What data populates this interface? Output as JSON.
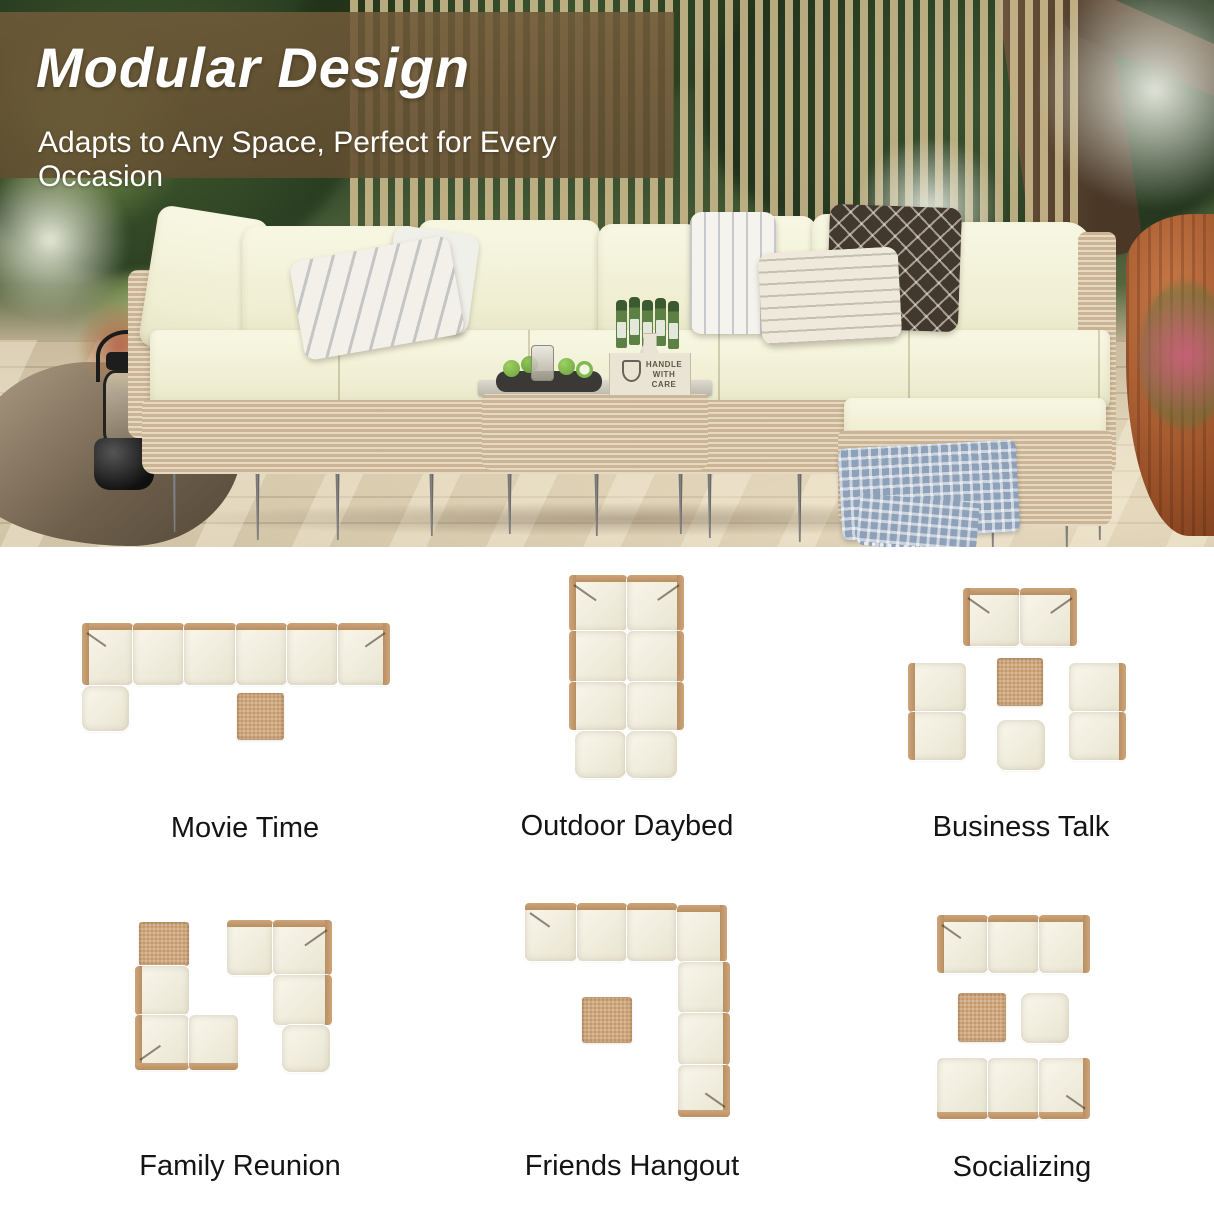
{
  "banner": {
    "title": "Modular Design",
    "subtitle": "Adapts to Any Space, Perfect for Every Occasion"
  },
  "photo": {
    "caddy_line1": "HANDLE",
    "caddy_line2": "WITH CARE"
  },
  "colors": {
    "cushion_cream": "#f2f0da",
    "wicker_frame": "#c49d72",
    "table_tan": "#d2a87c",
    "banner_brown": "#6d5737",
    "blanket_blue": "#8ea1b8",
    "label_text": "#141414"
  },
  "layouts": [
    {
      "id": "movie-time",
      "label": "Movie Time",
      "modules": [
        {
          "t": "seat",
          "x": 82,
          "y": 623,
          "w": 51,
          "h": 62,
          "back": "tl",
          "arm": "tl"
        },
        {
          "t": "seat",
          "x": 133,
          "y": 623,
          "w": 51,
          "h": 62,
          "back": "t"
        },
        {
          "t": "seat",
          "x": 184,
          "y": 623,
          "w": 52,
          "h": 62,
          "back": "t"
        },
        {
          "t": "seat",
          "x": 236,
          "y": 623,
          "w": 51,
          "h": 62,
          "back": "t"
        },
        {
          "t": "seat",
          "x": 287,
          "y": 623,
          "w": 51,
          "h": 62,
          "back": "t"
        },
        {
          "t": "seat",
          "x": 338,
          "y": 623,
          "w": 52,
          "h": 62,
          "back": "tr",
          "arm": "tr"
        },
        {
          "t": "ottoman",
          "x": 82,
          "y": 686,
          "w": 47,
          "h": 45
        },
        {
          "t": "table",
          "x": 237,
          "y": 693,
          "w": 47,
          "h": 47
        }
      ]
    },
    {
      "id": "outdoor-daybed",
      "label": "Outdoor Daybed",
      "modules": [
        {
          "t": "seat",
          "x": 569,
          "y": 575,
          "w": 58,
          "h": 56,
          "back": "tl",
          "arm": "tl"
        },
        {
          "t": "seat",
          "x": 627,
          "y": 575,
          "w": 57,
          "h": 56,
          "back": "tr",
          "arm": "tr"
        },
        {
          "t": "seat",
          "x": 569,
          "y": 631,
          "w": 58,
          "h": 51,
          "back": "l"
        },
        {
          "t": "seat",
          "x": 627,
          "y": 631,
          "w": 57,
          "h": 51,
          "back": "r"
        },
        {
          "t": "seat",
          "x": 569,
          "y": 682,
          "w": 58,
          "h": 48,
          "back": "l"
        },
        {
          "t": "seat",
          "x": 627,
          "y": 682,
          "w": 57,
          "h": 48,
          "back": "r"
        },
        {
          "t": "ottoman",
          "x": 575,
          "y": 731,
          "w": 51,
          "h": 47
        },
        {
          "t": "ottoman",
          "x": 626,
          "y": 731,
          "w": 51,
          "h": 47
        }
      ]
    },
    {
      "id": "business-talk",
      "label": "Business Talk",
      "modules": [
        {
          "t": "seat",
          "x": 963,
          "y": 588,
          "w": 57,
          "h": 58,
          "back": "tl",
          "arm": "tl"
        },
        {
          "t": "seat",
          "x": 1020,
          "y": 588,
          "w": 57,
          "h": 58,
          "back": "tr",
          "arm": "tr"
        },
        {
          "t": "seat",
          "x": 908,
          "y": 663,
          "w": 58,
          "h": 49,
          "back": "l"
        },
        {
          "t": "seat",
          "x": 908,
          "y": 712,
          "w": 58,
          "h": 48,
          "back": "l"
        },
        {
          "t": "seat",
          "x": 1069,
          "y": 663,
          "w": 57,
          "h": 49,
          "back": "r"
        },
        {
          "t": "seat",
          "x": 1069,
          "y": 712,
          "w": 57,
          "h": 48,
          "back": "r"
        },
        {
          "t": "table",
          "x": 997,
          "y": 658,
          "w": 46,
          "h": 48
        },
        {
          "t": "ottoman",
          "x": 997,
          "y": 720,
          "w": 48,
          "h": 50
        }
      ]
    },
    {
      "id": "family-reunion",
      "label": "Family Reunion",
      "modules": [
        {
          "t": "table",
          "x": 139,
          "y": 922,
          "w": 50,
          "h": 44
        },
        {
          "t": "seat",
          "x": 135,
          "y": 966,
          "w": 54,
          "h": 49,
          "back": "l"
        },
        {
          "t": "seat",
          "x": 135,
          "y": 1015,
          "w": 54,
          "h": 55,
          "back": "lb",
          "arm": "bl"
        },
        {
          "t": "seat",
          "x": 189,
          "y": 1015,
          "w": 49,
          "h": 55,
          "back": "b"
        },
        {
          "t": "seat",
          "x": 227,
          "y": 920,
          "w": 46,
          "h": 55,
          "back": "t"
        },
        {
          "t": "seat",
          "x": 273,
          "y": 920,
          "w": 59,
          "h": 55,
          "back": "tr",
          "arm": "tr"
        },
        {
          "t": "seat",
          "x": 273,
          "y": 975,
          "w": 59,
          "h": 50,
          "back": "r"
        },
        {
          "t": "ottoman",
          "x": 282,
          "y": 1025,
          "w": 48,
          "h": 47
        }
      ]
    },
    {
      "id": "friends-hangout",
      "label": "Friends Hangout",
      "modules": [
        {
          "t": "seat",
          "x": 525,
          "y": 903,
          "w": 52,
          "h": 58,
          "back": "t",
          "arm": "tl"
        },
        {
          "t": "seat",
          "x": 577,
          "y": 903,
          "w": 50,
          "h": 58,
          "back": "t"
        },
        {
          "t": "seat",
          "x": 627,
          "y": 903,
          "w": 50,
          "h": 58,
          "back": "t"
        },
        {
          "t": "seat",
          "x": 677,
          "y": 905,
          "w": 50,
          "h": 57,
          "back": "tr"
        },
        {
          "t": "seat",
          "x": 678,
          "y": 962,
          "w": 52,
          "h": 51,
          "back": "r"
        },
        {
          "t": "seat",
          "x": 678,
          "y": 1013,
          "w": 52,
          "h": 52,
          "back": "r"
        },
        {
          "t": "seat",
          "x": 678,
          "y": 1065,
          "w": 52,
          "h": 52,
          "back": "rb",
          "arm": "br"
        },
        {
          "t": "table",
          "x": 582,
          "y": 997,
          "w": 50,
          "h": 46
        }
      ]
    },
    {
      "id": "socializing",
      "label": "Socializing",
      "modules": [
        {
          "t": "seat",
          "x": 937,
          "y": 915,
          "w": 51,
          "h": 58,
          "back": "tl",
          "arm": "tl"
        },
        {
          "t": "seat",
          "x": 988,
          "y": 915,
          "w": 51,
          "h": 58,
          "back": "t"
        },
        {
          "t": "seat",
          "x": 1039,
          "y": 915,
          "w": 51,
          "h": 58,
          "back": "tr"
        },
        {
          "t": "table",
          "x": 958,
          "y": 993,
          "w": 48,
          "h": 49
        },
        {
          "t": "ottoman",
          "x": 1021,
          "y": 993,
          "w": 48,
          "h": 50
        },
        {
          "t": "seat",
          "x": 937,
          "y": 1058,
          "w": 51,
          "h": 61,
          "back": "b"
        },
        {
          "t": "seat",
          "x": 988,
          "y": 1058,
          "w": 51,
          "h": 61,
          "back": "b"
        },
        {
          "t": "seat",
          "x": 1039,
          "y": 1058,
          "w": 51,
          "h": 61,
          "back": "br",
          "arm": "br"
        }
      ]
    }
  ]
}
